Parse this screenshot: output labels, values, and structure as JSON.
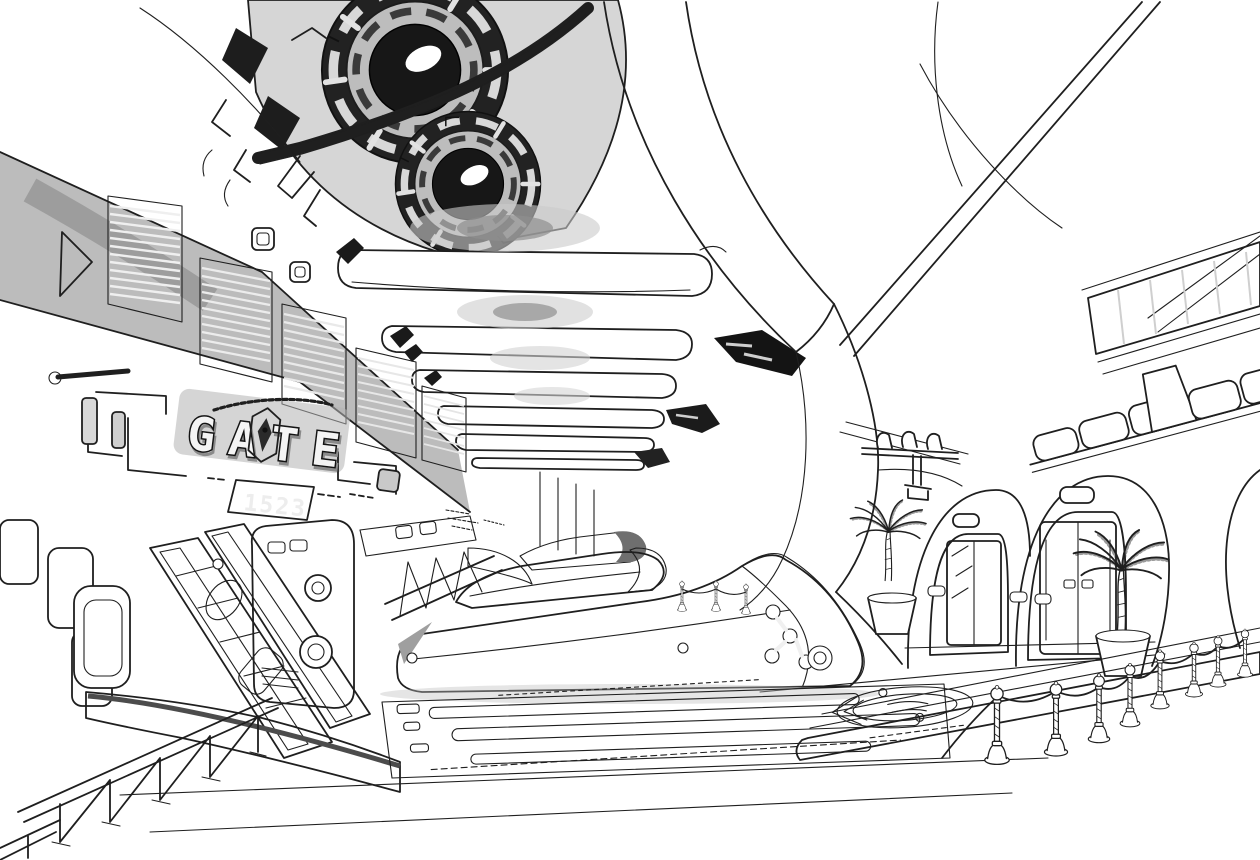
{
  "scene": {
    "title": "Spaceport gate hall concept drawing",
    "description": "Black-and-white pen-and-ink concept illustration of a futuristic terminal concourse: huge circular machinery rosettes on the ceiling, a louvered left wall bearing a stylized GATE sign with a number plate, boarding-ramp machinery and curved platform sleds receding toward the vanishing point, an organic white right wall with two arched double doorways, potted palm trees, a rope barrier of stanchions in the right foreground and a diagonal truss railing in the left foreground.",
    "medium": "ink line art with gray wash shading"
  },
  "signage": {
    "gate_sign": "GATE",
    "gate_number": "1523",
    "small_lettering": "illegible decorative micro-lettering above and below the sign"
  },
  "palette": {
    "paper": "#ffffff",
    "ink": "#1f1f1f",
    "wash_light": "#dcdcdc",
    "wash_mid": "#a0a0a0",
    "wash_dark": "#5c5c5c",
    "black_fill": "#161616"
  },
  "inventory": {
    "ceiling_rosettes": 2,
    "ceiling_beams": 6,
    "arched_doorways": 2,
    "palm_trees": 2,
    "rope_stanchions_foreground": 8,
    "rope_stanchions_distant": 3,
    "louver_vent_panels": 5
  }
}
